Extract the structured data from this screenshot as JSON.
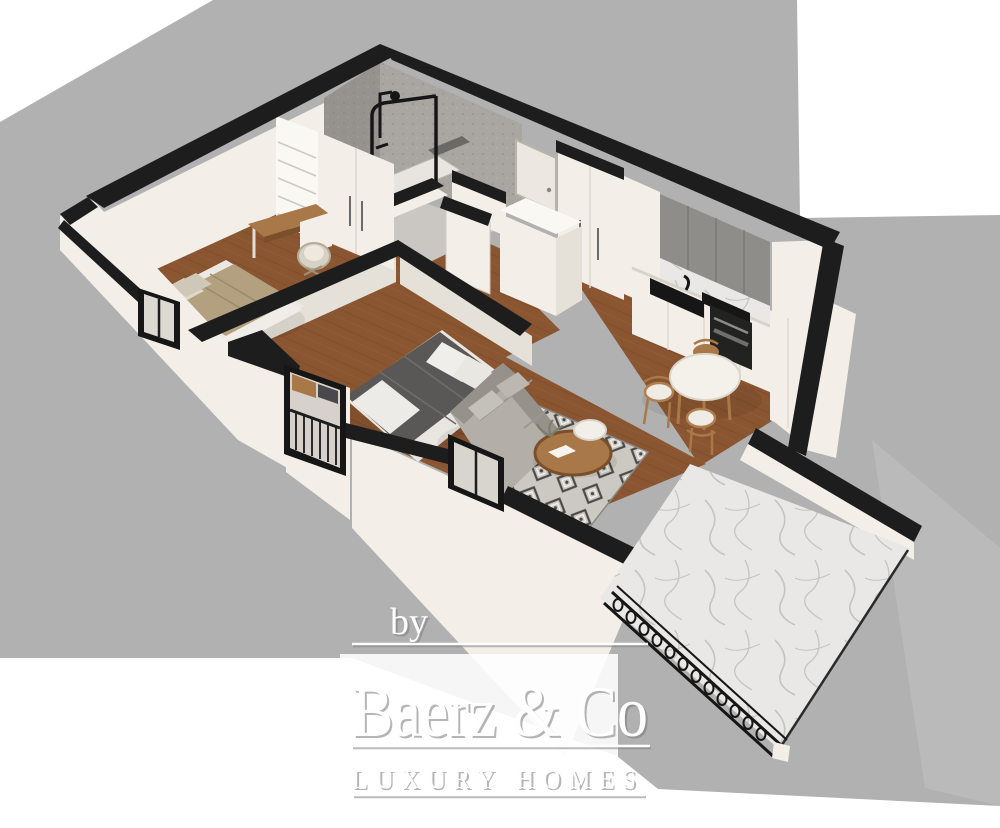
{
  "watermark": {
    "prefix": "by",
    "brand": "Baerz & Co",
    "tagline": "LUXURY HOMES"
  },
  "colors": {
    "backdrop": "#b1b1b1",
    "backdrop2": "#bababa",
    "wall": "#f3efe8",
    "wallshade": "#e6e1d8",
    "wallbright": "#faf8f3",
    "band": "#1d1d1d",
    "fixture": "#161616",
    "wood": "#8a5531",
    "woodline": "#74421f",
    "marble": "#eae8e6",
    "vein": "#c6c4c1",
    "stone": "#a9a6a1",
    "stoned": "#96938e",
    "rug": "#ccc9c2",
    "rugmotif": "#4b4a48",
    "sofa": "#b3afa8",
    "sofad": "#96928b",
    "duvet": "#595856",
    "khaki": "#b2a07f",
    "tablewood": "#a97848",
    "cabinet": "#8f8d8a",
    "box": "#f5f1ea"
  }
}
